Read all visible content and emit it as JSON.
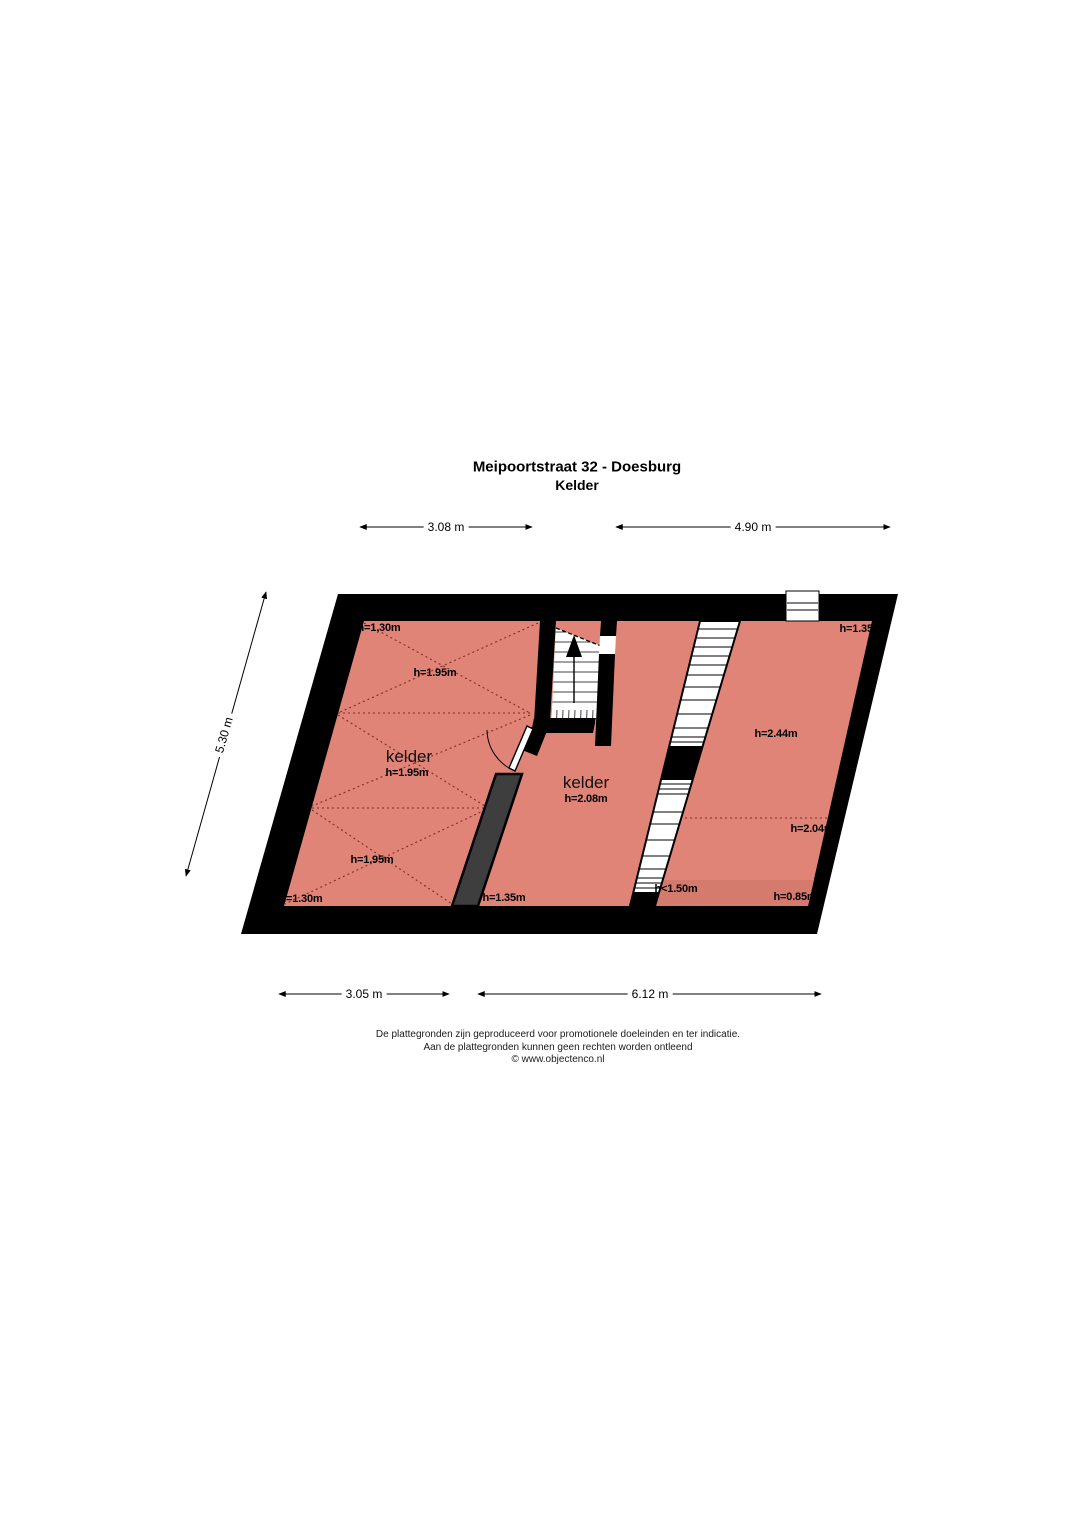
{
  "title": {
    "line1": "Meipoortstraat 32 - Doesburg",
    "line2": "Kelder"
  },
  "dimensions": {
    "top_left": "3.08 m",
    "top_right": "4.90 m",
    "left": "5.30 m",
    "bottom_left": "3.05 m",
    "bottom_right": "6.12 m"
  },
  "rooms": {
    "left": {
      "name": "kelder",
      "height_top_left": "h=1,30m",
      "height_upper": "h=1.95m",
      "height_middle": "h=1.95m",
      "height_lower": "h=1.95m",
      "height_bottom_left": "h=1.30m",
      "height_bottom_right": "h=1.35m"
    },
    "middle": {
      "name": "kelder",
      "height": "h=2.08m"
    },
    "right": {
      "height_top_right": "h=1.35m",
      "height_center": "h=2.44m",
      "height_lower": "h=2.04m",
      "height_bottom_left": "h<1.50m",
      "height_bottom_right": "h=0.85m"
    }
  },
  "footer": {
    "line1": "De plattegronden zijn geproduceerd voor promotionele doeleinden en ter indicatie.",
    "line2": "Aan de plattegronden kunnen geen rechten worden ontleend",
    "line3": "© www.objectenco.nl"
  },
  "colors": {
    "floor": "#e08478",
    "floor_dark": "#d47b6e",
    "wall": "#000000",
    "vault_line": "#7d2d20",
    "gray_wall": "#3e3e3e"
  }
}
